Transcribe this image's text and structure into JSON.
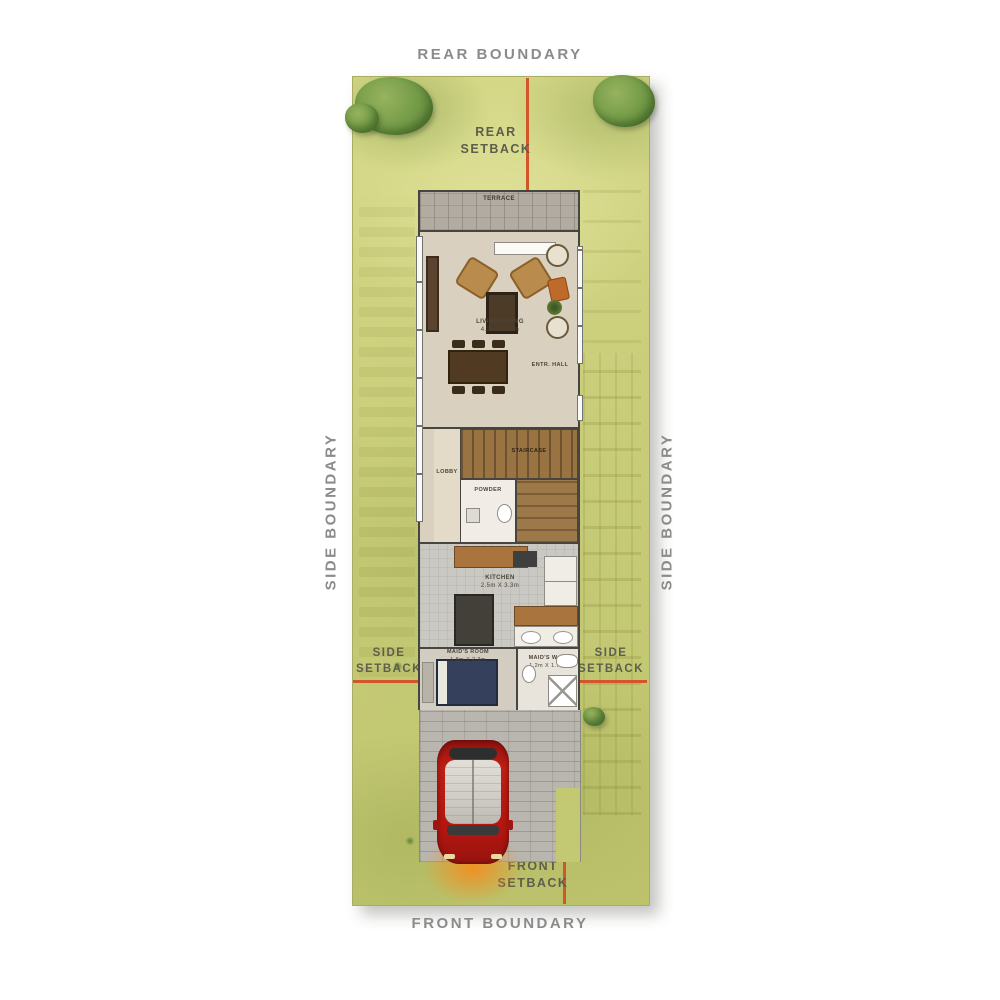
{
  "boundaries": {
    "rear": "REAR BOUNDARY",
    "front": "FRONT BOUNDARY",
    "side_left": "SIDE BOUNDARY",
    "side_right": "SIDE BOUNDARY"
  },
  "setbacks": {
    "rear": {
      "l1": "REAR",
      "l2": "SETBACK"
    },
    "front": {
      "l1": "FRONT",
      "l2": "SETBACK"
    },
    "side_left": {
      "l1": "SIDE",
      "l2": "SETBACK"
    },
    "side_right": {
      "l1": "SIDE",
      "l2": "SETBACK"
    }
  },
  "rooms": {
    "terrace": {
      "name": "TERRACE"
    },
    "living": {
      "name": "LIVING/DINING",
      "dims": "4.2m X 3.6m"
    },
    "entry": {
      "name": "ENTR. HALL"
    },
    "stair": {
      "name": "STAIRCASE"
    },
    "lobby": {
      "name": "LOBBY"
    },
    "powder": {
      "name": "POWDER"
    },
    "kitchen": {
      "name": "KITCHEN",
      "dims": "2.5m X 3.3m"
    },
    "maid": {
      "name": "MAID'S ROOM",
      "dims": "1.8m X 2.3m"
    },
    "maid_wc": {
      "name": "MAID'S W.C.",
      "dims": "1.2m X 1.7m"
    }
  },
  "colors": {
    "plot_green": "#c9cd7a",
    "setback_line": "#d4552a",
    "boundary_text": "#8b8b8b",
    "wall": "#47453f",
    "car_red": "#b5160f",
    "stair_wood": "#9a7342"
  }
}
